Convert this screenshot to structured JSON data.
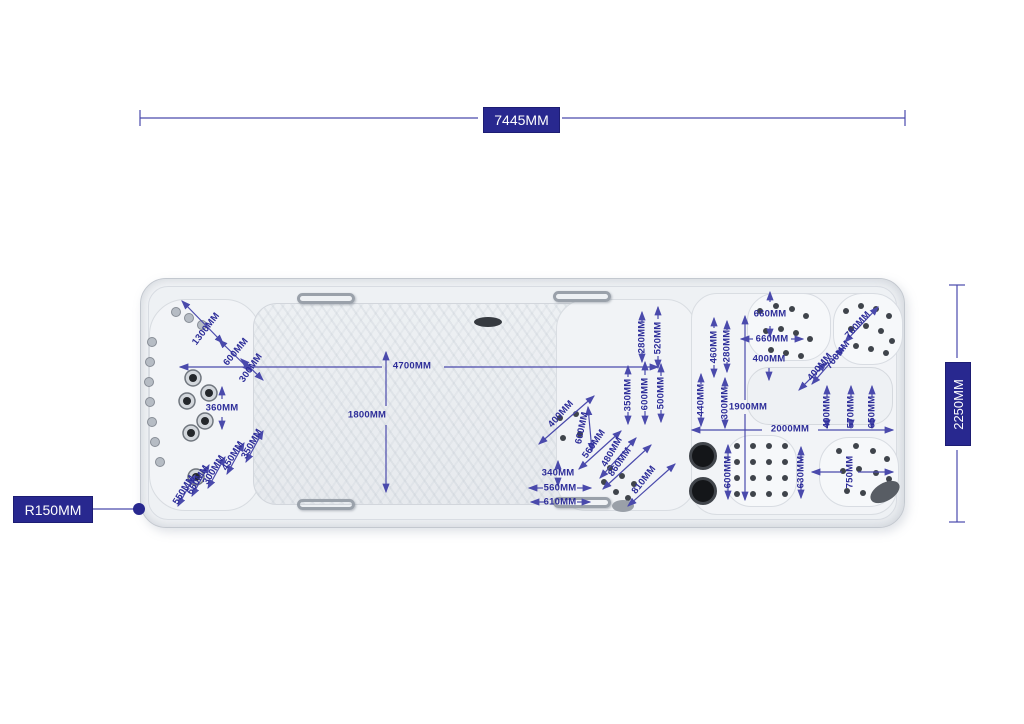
{
  "diagram": {
    "title": "swim spa top view dimension drawing",
    "boxes": {
      "top": "7445MM",
      "right": "2250MM",
      "left": "R150MM"
    },
    "colors": {
      "dimension_text": "#2d2d99",
      "line": "#4a4aac",
      "box_bg": "#28288f",
      "box_text": "#ffffff"
    },
    "annotations": [
      {
        "t": "1300MM",
        "x": 206,
        "y": 329,
        "r": -52
      },
      {
        "t": "600MM",
        "x": 236,
        "y": 352,
        "r": -50
      },
      {
        "t": "300MM",
        "x": 251,
        "y": 368,
        "r": -55
      },
      {
        "t": "4700MM",
        "x": 412,
        "y": 366,
        "r": 0
      },
      {
        "t": "1800MM",
        "x": 367,
        "y": 415,
        "r": 0
      },
      {
        "t": "360MM",
        "x": 222,
        "y": 408,
        "r": 0
      },
      {
        "t": "350MM",
        "x": 252,
        "y": 444,
        "r": -60
      },
      {
        "t": "450MM",
        "x": 233,
        "y": 456,
        "r": -58
      },
      {
        "t": "300MM",
        "x": 214,
        "y": 470,
        "r": -58
      },
      {
        "t": "650MM",
        "x": 198,
        "y": 480,
        "r": -58
      },
      {
        "t": "550MM",
        "x": 184,
        "y": 490,
        "r": -58
      },
      {
        "t": "400MM",
        "x": 561,
        "y": 414,
        "r": -48
      },
      {
        "t": "600MM",
        "x": 582,
        "y": 428,
        "r": -78
      },
      {
        "t": "560MM",
        "x": 594,
        "y": 444,
        "r": -55
      },
      {
        "t": "480MM",
        "x": 612,
        "y": 452,
        "r": -60
      },
      {
        "t": "860MM",
        "x": 620,
        "y": 462,
        "r": -55
      },
      {
        "t": "810MM",
        "x": 644,
        "y": 480,
        "r": -52
      },
      {
        "t": "340MM",
        "x": 558,
        "y": 473,
        "r": 0
      },
      {
        "t": "560MM",
        "x": 560,
        "y": 488,
        "r": 0
      },
      {
        "t": "610MM",
        "x": 560,
        "y": 502,
        "r": 0
      },
      {
        "t": "350MM",
        "x": 628,
        "y": 395,
        "r": -90
      },
      {
        "t": "600MM",
        "x": 645,
        "y": 394,
        "r": -90
      },
      {
        "t": "500MM",
        "x": 661,
        "y": 393,
        "r": -90
      },
      {
        "t": "280MM",
        "x": 642,
        "y": 337,
        "r": -90
      },
      {
        "t": "520MM",
        "x": 658,
        "y": 338,
        "r": -90
      },
      {
        "t": "460MM",
        "x": 714,
        "y": 347,
        "r": -90
      },
      {
        "t": "280MM",
        "x": 727,
        "y": 346,
        "r": -90
      },
      {
        "t": "440MM",
        "x": 701,
        "y": 400,
        "r": -90
      },
      {
        "t": "300MM",
        "x": 725,
        "y": 403,
        "r": -90
      },
      {
        "t": "660MM",
        "x": 770,
        "y": 314,
        "r": 0
      },
      {
        "t": "660MM",
        "x": 772,
        "y": 339,
        "r": 0
      },
      {
        "t": "400MM",
        "x": 769,
        "y": 359,
        "r": 0
      },
      {
        "t": "1900MM",
        "x": 748,
        "y": 407,
        "r": 0
      },
      {
        "t": "700MM",
        "x": 838,
        "y": 355,
        "r": -52
      },
      {
        "t": "760MM",
        "x": 858,
        "y": 325,
        "r": -48
      },
      {
        "t": "400MM",
        "x": 820,
        "y": 367,
        "r": -50
      },
      {
        "t": "400MM",
        "x": 827,
        "y": 412,
        "r": -90
      },
      {
        "t": "570MM",
        "x": 851,
        "y": 412,
        "r": -90
      },
      {
        "t": "650MM",
        "x": 872,
        "y": 412,
        "r": -90
      },
      {
        "t": "2000MM",
        "x": 790,
        "y": 429,
        "r": 0
      },
      {
        "t": "600MM",
        "x": 728,
        "y": 472,
        "r": -90
      },
      {
        "t": "630MM",
        "x": 801,
        "y": 472,
        "r": -90
      },
      {
        "t": "750MM",
        "x": 850,
        "y": 472,
        "r": -90
      }
    ],
    "lines": [
      {
        "x1": 140,
        "y1": 110,
        "x2": 140,
        "y2": 126,
        "s": 0,
        "e": 0
      },
      {
        "x1": 905,
        "y1": 110,
        "x2": 905,
        "y2": 126,
        "s": 0,
        "e": 0
      },
      {
        "x1": 140,
        "y1": 118,
        "x2": 478,
        "y2": 118,
        "s": 0,
        "e": 0
      },
      {
        "x1": 562,
        "y1": 118,
        "x2": 905,
        "y2": 118,
        "s": 0,
        "e": 0
      },
      {
        "x1": 949,
        "y1": 285,
        "x2": 965,
        "y2": 285,
        "s": 0,
        "e": 0
      },
      {
        "x1": 949,
        "y1": 522,
        "x2": 965,
        "y2": 522,
        "s": 0,
        "e": 0
      },
      {
        "x1": 957,
        "y1": 285,
        "x2": 957,
        "y2": 358,
        "s": 0,
        "e": 0
      },
      {
        "x1": 957,
        "y1": 450,
        "x2": 957,
        "y2": 522,
        "s": 0,
        "e": 0
      },
      {
        "x1": 92,
        "y1": 509,
        "x2": 135,
        "y2": 509,
        "s": 0,
        "e": 0
      },
      {
        "x1": 180,
        "y1": 367,
        "x2": 382,
        "y2": 367,
        "s": 1,
        "e": 0
      },
      {
        "x1": 444,
        "y1": 367,
        "x2": 658,
        "y2": 367,
        "s": 0,
        "e": 1
      },
      {
        "x1": 386,
        "y1": 352,
        "x2": 386,
        "y2": 406,
        "s": 1,
        "e": 0
      },
      {
        "x1": 386,
        "y1": 425,
        "x2": 386,
        "y2": 492,
        "s": 0,
        "e": 1
      },
      {
        "x1": 745,
        "y1": 316,
        "x2": 745,
        "y2": 400,
        "s": 1,
        "e": 0
      },
      {
        "x1": 745,
        "y1": 414,
        "x2": 745,
        "y2": 500,
        "s": 0,
        "e": 1
      },
      {
        "x1": 692,
        "y1": 430,
        "x2": 762,
        "y2": 430,
        "s": 1,
        "e": 0
      },
      {
        "x1": 818,
        "y1": 430,
        "x2": 893,
        "y2": 430,
        "s": 0,
        "e": 1
      },
      {
        "x1": 812,
        "y1": 472,
        "x2": 842,
        "y2": 472,
        "s": 1,
        "e": 0
      },
      {
        "x1": 858,
        "y1": 472,
        "x2": 893,
        "y2": 472,
        "s": 0,
        "e": 1
      },
      {
        "x1": 182,
        "y1": 301,
        "x2": 223,
        "y2": 343,
        "s": 1,
        "e": 1
      },
      {
        "x1": 219,
        "y1": 340,
        "x2": 251,
        "y2": 371,
        "s": 1,
        "e": 1
      },
      {
        "x1": 241,
        "y1": 359,
        "x2": 263,
        "y2": 380,
        "s": 1,
        "e": 1
      },
      {
        "x1": 222,
        "y1": 387,
        "x2": 222,
        "y2": 399,
        "s": 1,
        "e": 0
      },
      {
        "x1": 222,
        "y1": 417,
        "x2": 222,
        "y2": 429,
        "s": 0,
        "e": 1
      },
      {
        "x1": 246,
        "y1": 462,
        "x2": 263,
        "y2": 431,
        "s": 1,
        "e": 1
      },
      {
        "x1": 227,
        "y1": 474,
        "x2": 244,
        "y2": 443,
        "s": 1,
        "e": 1
      },
      {
        "x1": 208,
        "y1": 488,
        "x2": 225,
        "y2": 457,
        "s": 1,
        "e": 1
      },
      {
        "x1": 192,
        "y1": 496,
        "x2": 209,
        "y2": 465,
        "s": 1,
        "e": 1
      },
      {
        "x1": 178,
        "y1": 506,
        "x2": 195,
        "y2": 475,
        "s": 1,
        "e": 1
      },
      {
        "x1": 539,
        "y1": 444,
        "x2": 594,
        "y2": 396,
        "s": 1,
        "e": 1
      },
      {
        "x1": 588,
        "y1": 407,
        "x2": 592,
        "y2": 451,
        "s": 1,
        "e": 1
      },
      {
        "x1": 579,
        "y1": 469,
        "x2": 621,
        "y2": 431,
        "s": 1,
        "e": 1
      },
      {
        "x1": 600,
        "y1": 478,
        "x2": 636,
        "y2": 438,
        "s": 1,
        "e": 1
      },
      {
        "x1": 603,
        "y1": 489,
        "x2": 651,
        "y2": 445,
        "s": 1,
        "e": 1
      },
      {
        "x1": 628,
        "y1": 506,
        "x2": 675,
        "y2": 464,
        "s": 1,
        "e": 1
      },
      {
        "x1": 558,
        "y1": 461,
        "x2": 558,
        "y2": 468,
        "s": 1,
        "e": 0
      },
      {
        "x1": 558,
        "y1": 478,
        "x2": 558,
        "y2": 486,
        "s": 0,
        "e": 1
      },
      {
        "x1": 529,
        "y1": 488,
        "x2": 543,
        "y2": 488,
        "s": 1,
        "e": 0
      },
      {
        "x1": 577,
        "y1": 488,
        "x2": 591,
        "y2": 488,
        "s": 0,
        "e": 1
      },
      {
        "x1": 531,
        "y1": 502,
        "x2": 545,
        "y2": 502,
        "s": 1,
        "e": 0
      },
      {
        "x1": 577,
        "y1": 502,
        "x2": 590,
        "y2": 502,
        "s": 0,
        "e": 1
      },
      {
        "x1": 628,
        "y1": 366,
        "x2": 628,
        "y2": 377,
        "s": 1,
        "e": 0
      },
      {
        "x1": 628,
        "y1": 412,
        "x2": 628,
        "y2": 424,
        "s": 0,
        "e": 1
      },
      {
        "x1": 645,
        "y1": 362,
        "x2": 645,
        "y2": 375,
        "s": 1,
        "e": 0
      },
      {
        "x1": 645,
        "y1": 411,
        "x2": 645,
        "y2": 424,
        "s": 0,
        "e": 1
      },
      {
        "x1": 661,
        "y1": 364,
        "x2": 661,
        "y2": 376,
        "s": 1,
        "e": 0
      },
      {
        "x1": 661,
        "y1": 410,
        "x2": 661,
        "y2": 422,
        "s": 0,
        "e": 1
      },
      {
        "x1": 642,
        "y1": 312,
        "x2": 642,
        "y2": 322,
        "s": 1,
        "e": 0
      },
      {
        "x1": 642,
        "y1": 352,
        "x2": 642,
        "y2": 362,
        "s": 0,
        "e": 1
      },
      {
        "x1": 658,
        "y1": 307,
        "x2": 658,
        "y2": 319,
        "s": 1,
        "e": 0
      },
      {
        "x1": 658,
        "y1": 356,
        "x2": 658,
        "y2": 368,
        "s": 0,
        "e": 1
      },
      {
        "x1": 714,
        "y1": 318,
        "x2": 714,
        "y2": 328,
        "s": 1,
        "e": 0
      },
      {
        "x1": 714,
        "y1": 365,
        "x2": 714,
        "y2": 377,
        "s": 0,
        "e": 1
      },
      {
        "x1": 727,
        "y1": 321,
        "x2": 727,
        "y2": 330,
        "s": 1,
        "e": 0
      },
      {
        "x1": 727,
        "y1": 362,
        "x2": 727,
        "y2": 372,
        "s": 0,
        "e": 1
      },
      {
        "x1": 701,
        "y1": 374,
        "x2": 701,
        "y2": 384,
        "s": 1,
        "e": 0
      },
      {
        "x1": 701,
        "y1": 416,
        "x2": 701,
        "y2": 426,
        "s": 0,
        "e": 1
      },
      {
        "x1": 725,
        "y1": 378,
        "x2": 725,
        "y2": 388,
        "s": 1,
        "e": 0
      },
      {
        "x1": 725,
        "y1": 418,
        "x2": 725,
        "y2": 428,
        "s": 0,
        "e": 1
      },
      {
        "x1": 770,
        "y1": 292,
        "x2": 770,
        "y2": 302,
        "s": 1,
        "e": 0
      },
      {
        "x1": 770,
        "y1": 326,
        "x2": 770,
        "y2": 337,
        "s": 0,
        "e": 1
      },
      {
        "x1": 741,
        "y1": 339,
        "x2": 753,
        "y2": 339,
        "s": 1,
        "e": 0
      },
      {
        "x1": 791,
        "y1": 339,
        "x2": 803,
        "y2": 339,
        "s": 0,
        "e": 1
      },
      {
        "x1": 769,
        "y1": 368,
        "x2": 769,
        "y2": 380,
        "s": 0,
        "e": 1
      },
      {
        "x1": 812,
        "y1": 384,
        "x2": 844,
        "y2": 347,
        "s": 1,
        "e": 1
      },
      {
        "x1": 845,
        "y1": 342,
        "x2": 878,
        "y2": 307,
        "s": 1,
        "e": 1
      },
      {
        "x1": 799,
        "y1": 390,
        "x2": 826,
        "y2": 363,
        "s": 1,
        "e": 1
      },
      {
        "x1": 827,
        "y1": 386,
        "x2": 827,
        "y2": 397,
        "s": 1,
        "e": 0
      },
      {
        "x1": 827,
        "y1": 419,
        "x2": 827,
        "y2": 428,
        "s": 0,
        "e": 1
      },
      {
        "x1": 851,
        "y1": 386,
        "x2": 851,
        "y2": 397,
        "s": 1,
        "e": 0
      },
      {
        "x1": 851,
        "y1": 419,
        "x2": 851,
        "y2": 428,
        "s": 0,
        "e": 1
      },
      {
        "x1": 872,
        "y1": 386,
        "x2": 872,
        "y2": 397,
        "s": 1,
        "e": 0
      },
      {
        "x1": 872,
        "y1": 419,
        "x2": 872,
        "y2": 428,
        "s": 0,
        "e": 1
      },
      {
        "x1": 728,
        "y1": 445,
        "x2": 728,
        "y2": 461,
        "s": 1,
        "e": 0
      },
      {
        "x1": 728,
        "y1": 482,
        "x2": 728,
        "y2": 499,
        "s": 0,
        "e": 1
      },
      {
        "x1": 801,
        "y1": 447,
        "x2": 801,
        "y2": 463,
        "s": 1,
        "e": 0
      },
      {
        "x1": 801,
        "y1": 481,
        "x2": 801,
        "y2": 498,
        "s": 0,
        "e": 1
      }
    ],
    "leader_dot": {
      "x": 139,
      "y": 509,
      "r": 6
    },
    "jets": {
      "rim": [
        [
          152,
          342
        ],
        [
          150,
          362
        ],
        [
          149,
          382
        ],
        [
          150,
          402
        ],
        [
          152,
          422
        ],
        [
          155,
          442
        ],
        [
          160,
          462
        ],
        [
          176,
          312
        ],
        [
          189,
          318
        ],
        [
          202,
          325
        ]
      ],
      "chrome": [
        [
          193,
          378
        ],
        [
          209,
          393
        ],
        [
          187,
          401
        ],
        [
          205,
          421
        ],
        [
          191,
          433
        ],
        [
          196,
          477
        ]
      ],
      "dark": [
        [
          760,
          311
        ],
        [
          776,
          306
        ],
        [
          792,
          309
        ],
        [
          806,
          316
        ],
        [
          766,
          331
        ],
        [
          781,
          329
        ],
        [
          796,
          333
        ],
        [
          810,
          339
        ],
        [
          771,
          350
        ],
        [
          786,
          353
        ],
        [
          801,
          356
        ],
        [
          846,
          311
        ],
        [
          861,
          306
        ],
        [
          876,
          309
        ],
        [
          889,
          316
        ],
        [
          851,
          329
        ],
        [
          866,
          326
        ],
        [
          881,
          331
        ],
        [
          892,
          341
        ],
        [
          856,
          346
        ],
        [
          871,
          349
        ],
        [
          886,
          353
        ],
        [
          737,
          446
        ],
        [
          753,
          446
        ],
        [
          769,
          446
        ],
        [
          785,
          446
        ],
        [
          737,
          462
        ],
        [
          753,
          462
        ],
        [
          769,
          462
        ],
        [
          785,
          462
        ],
        [
          737,
          478
        ],
        [
          753,
          478
        ],
        [
          769,
          478
        ],
        [
          785,
          478
        ],
        [
          737,
          494
        ],
        [
          753,
          494
        ],
        [
          769,
          494
        ],
        [
          785,
          494
        ],
        [
          839,
          451
        ],
        [
          856,
          446
        ],
        [
          873,
          451
        ],
        [
          887,
          459
        ],
        [
          843,
          471
        ],
        [
          859,
          469
        ],
        [
          876,
          473
        ],
        [
          889,
          479
        ],
        [
          847,
          491
        ],
        [
          863,
          493
        ],
        [
          879,
          496
        ],
        [
          560,
          418
        ],
        [
          576,
          414
        ],
        [
          563,
          438
        ],
        [
          580,
          434
        ],
        [
          610,
          468
        ],
        [
          622,
          476
        ],
        [
          634,
          484
        ],
        [
          604,
          482
        ],
        [
          616,
          492
        ],
        [
          628,
          498
        ]
      ],
      "knobs": [
        [
          703,
          456
        ],
        [
          703,
          491
        ]
      ],
      "ellipses": [
        {
          "x": 885,
          "y": 492,
          "rx": 16,
          "ry": 9,
          "rot": -30,
          "fill": "#585d64"
        },
        {
          "x": 623,
          "y": 506,
          "rx": 11,
          "ry": 6,
          "rot": 0,
          "fill": "#9aa0a8"
        },
        {
          "x": 488,
          "y": 322,
          "rx": 14,
          "ry": 5,
          "rot": 0,
          "fill": "#363a40"
        }
      ]
    }
  }
}
